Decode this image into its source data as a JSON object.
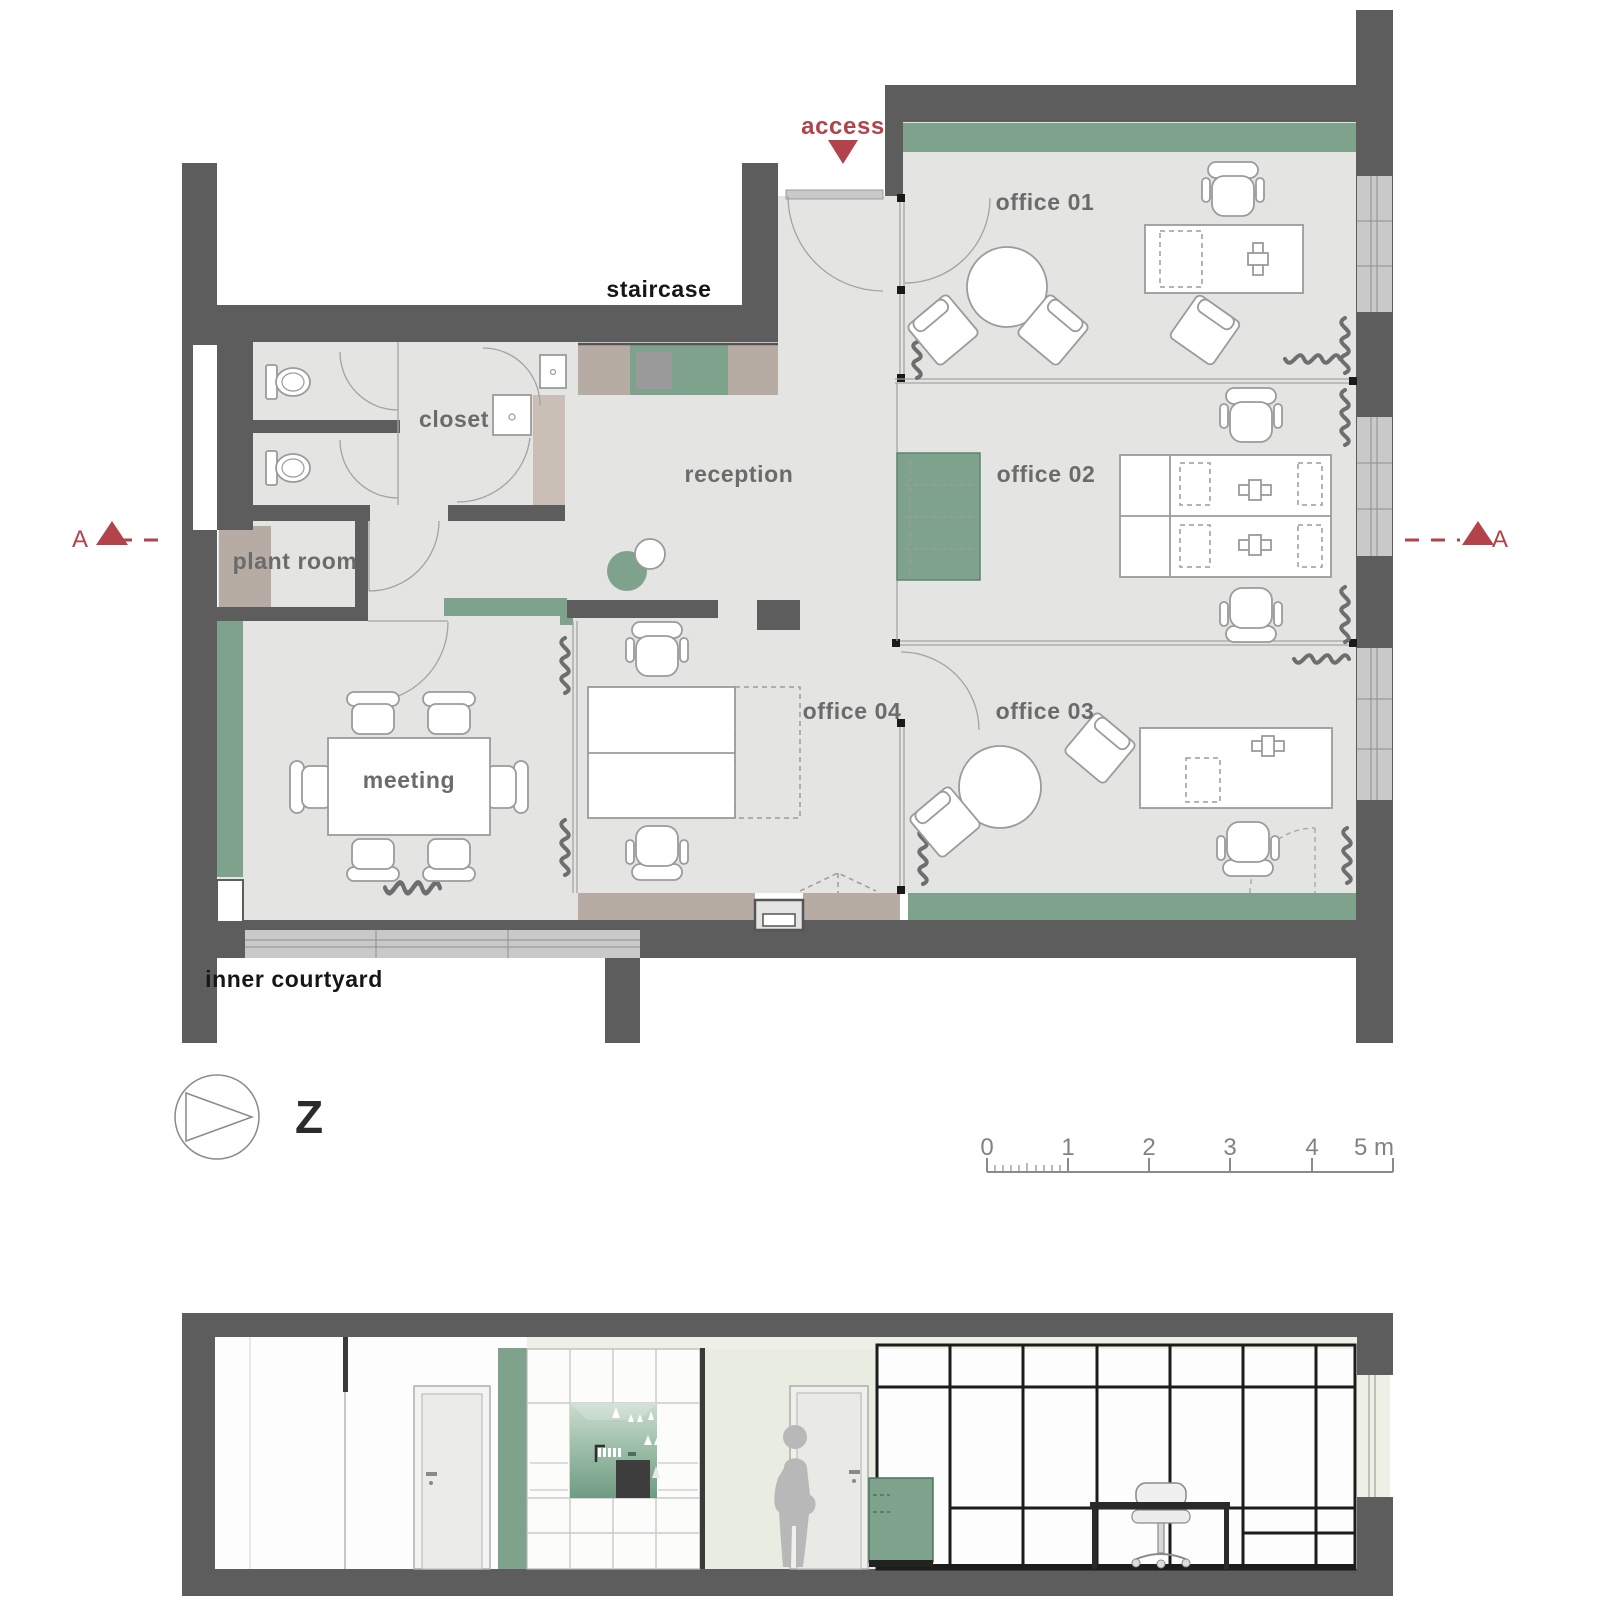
{
  "colors": {
    "wall": "#5d5d5d",
    "floor": "#e4e4e3",
    "green": "#7fa28d",
    "beige": "#b7aca4",
    "beigelight": "#cabfb7",
    "window": "#c9c9c9",
    "red": "#b2434b",
    "labelgray": "#6b6b6b",
    "labeldark": "#161616",
    "pale": "#eef0e5",
    "sectionwall": "#e9ece1",
    "glassframe": "#1c1c1c"
  },
  "plan": {
    "rooms": [
      {
        "id": "office-01",
        "label": "office 01"
      },
      {
        "id": "office-02",
        "label": "office 02"
      },
      {
        "id": "office-03",
        "label": "office 03"
      },
      {
        "id": "office-04",
        "label": "office 04"
      },
      {
        "id": "reception",
        "label": "reception"
      },
      {
        "id": "meeting",
        "label": "meeting"
      },
      {
        "id": "closet",
        "label": "closet"
      },
      {
        "id": "plant-room",
        "label": "plant room"
      }
    ],
    "annotations": {
      "access": "access",
      "staircase": "staircase",
      "inner_courtyard": "inner courtyard",
      "section_marker": "A",
      "north_label": "Z"
    }
  },
  "scalebar": {
    "unit_labels": [
      "0",
      "1",
      "2",
      "3",
      "4",
      "5 m"
    ]
  }
}
